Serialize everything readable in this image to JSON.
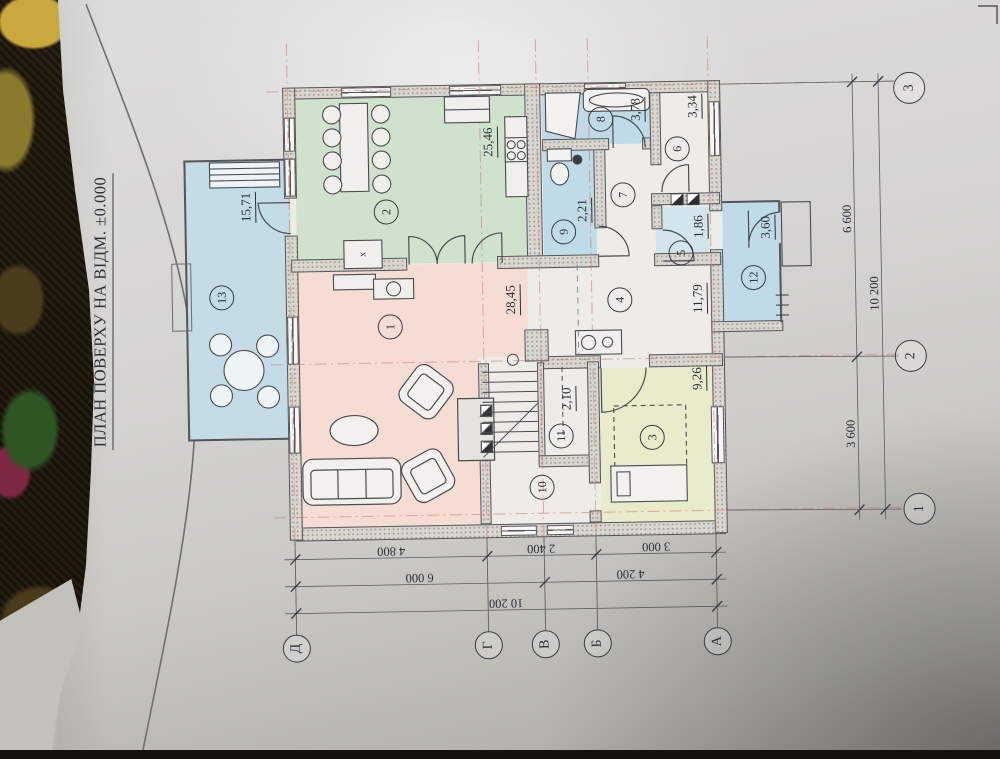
{
  "title": "ПЛАН ПОВЕРХУ НА ВІДМ. ±0.000",
  "rooms": [
    {
      "num": "1",
      "area": "28,45"
    },
    {
      "num": "2",
      "area": "25,46"
    },
    {
      "num": "3",
      "area": "9,26"
    },
    {
      "num": "4",
      "area": "11,79"
    },
    {
      "num": "5",
      "area": "1,86"
    },
    {
      "num": "6",
      "area": "3,34"
    },
    {
      "num": "7",
      "area": ""
    },
    {
      "num": "8",
      "area": "3,78"
    },
    {
      "num": "9",
      "area": "2,21"
    },
    {
      "num": "10",
      "area": ""
    },
    {
      "num": "11",
      "area": "2,10"
    },
    {
      "num": "12",
      "area": "3,60"
    },
    {
      "num": "13",
      "area": "15,71"
    }
  ],
  "kitchen_island_marker": "x",
  "axes": {
    "bottom": [
      "Д",
      "Г",
      "В",
      "Б",
      "А"
    ],
    "right": [
      "3",
      "2",
      "1"
    ]
  },
  "dimensions": {
    "bottom": {
      "row1": [
        "4 800",
        "2 400",
        "3 000"
      ],
      "row2": [
        "6 000",
        "4 200"
      ],
      "total": "10 200"
    },
    "right": {
      "segments": [
        "6 600",
        "3 600"
      ],
      "total": "10 200"
    }
  },
  "colors": {
    "living": "#f5ddd3",
    "dining_kitchen": "#cfe2cb",
    "wet_rooms": "#bedbe7",
    "terrace": "#c3dce6",
    "bedroom": "#e9ecca",
    "axis_red": "#cc7b72",
    "ink": "#2c2e35",
    "paper": "#d6d5d1"
  }
}
